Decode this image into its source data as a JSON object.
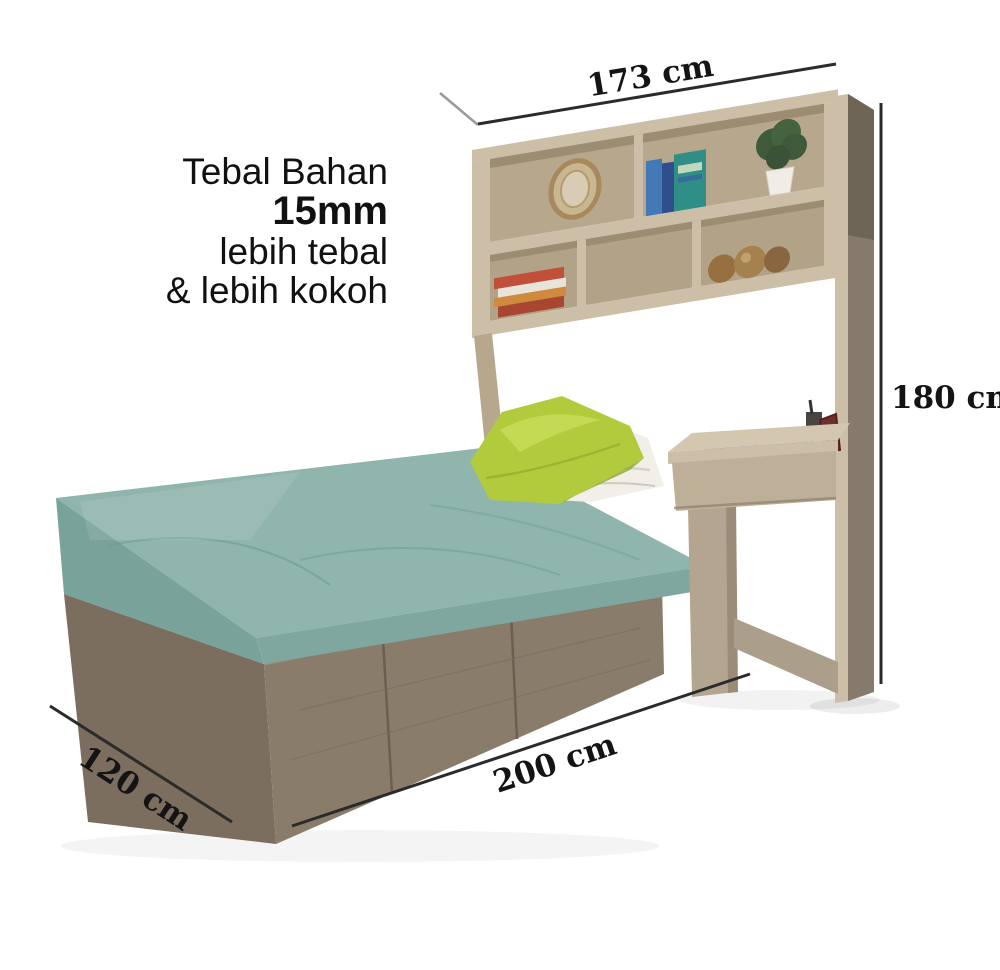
{
  "annotation": {
    "line1": "Tebal Bahan",
    "line2": "15mm",
    "line3": "lebih tebal",
    "line4": "& lebih kokoh"
  },
  "dimensions": {
    "top_width": "173 cm",
    "right_height": "180 cm",
    "bottom_length": "200 cm",
    "bottom_depth": "120 cm"
  },
  "colors": {
    "background": "#ffffff",
    "dim_line": "#2b2b2b",
    "text": "#111111",
    "wood_light": "#cdbfa7",
    "wood_mid": "#b7a88d",
    "wood_back": "#b2a388",
    "wood_dark": "#8a7c6a",
    "wood_darker": "#7b6e5f",
    "wood_side": "#857a6b",
    "mattress_teal": "#8fb5ad",
    "mattress_teal_dark": "#79a29a",
    "pillow_lime": "#b2cb3d",
    "pillow_white": "#f2efe8",
    "plant_green": "#3f5a3b",
    "pot_white": "#efede6",
    "book_blue": "#4479b8",
    "book_teal": "#2f8f86",
    "book_red": "#c0503a",
    "book_orange": "#cf8a3e",
    "bronze": "#96703f",
    "frame_gold": "#a8885c",
    "frame_maroon": "#6e2f2c"
  },
  "scene": {
    "items": [
      "bed-with-storage-drawers",
      "teal-fitted-mattress",
      "lime-green-pillow",
      "white-pillow",
      "overbed-shelf-unit",
      "oval-mirror-frame",
      "standing-books",
      "potted-plant",
      "stacked-books",
      "bronze-decor-balls",
      "attached-desk-with-drawer",
      "tall-side-panel"
    ]
  }
}
